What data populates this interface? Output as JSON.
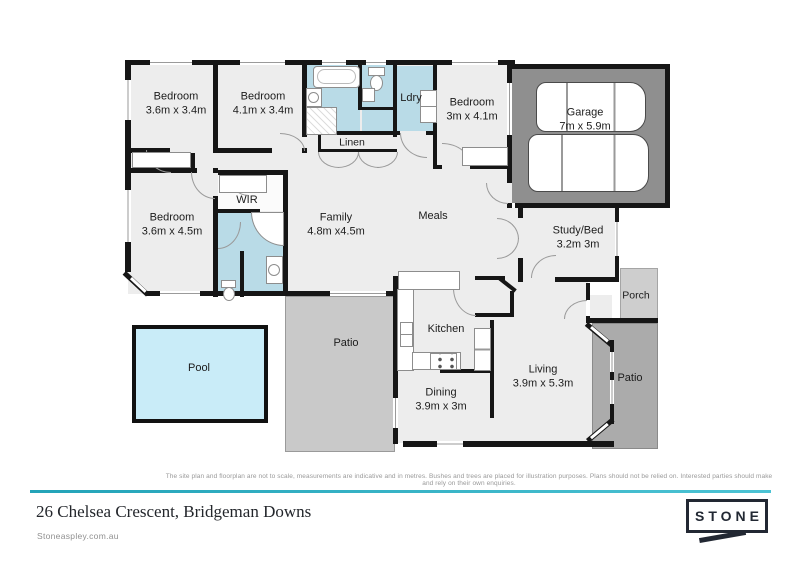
{
  "floorplan": {
    "rooms": [
      {
        "label": "Bedroom",
        "dims": "3.6m x 3.4m"
      },
      {
        "label": "Bedroom",
        "dims": "4.1m x 3.4m"
      },
      {
        "label": "Linen",
        "dims": ""
      },
      {
        "label": "Ldry",
        "dims": ""
      },
      {
        "label": "Bedroom",
        "dims": "3m x 4.1m"
      },
      {
        "label": "Garage",
        "dims": "7m x 5.9m"
      },
      {
        "label": "WIR",
        "dims": ""
      },
      {
        "label": "Bedroom",
        "dims": "3.6m x 4.5m"
      },
      {
        "label": "Family",
        "dims": "4.8m x4.5m"
      },
      {
        "label": "Meals",
        "dims": ""
      },
      {
        "label": "Study/Bed",
        "dims": "3.2m 3m"
      },
      {
        "label": "Porch",
        "dims": ""
      },
      {
        "label": "Kitchen",
        "dims": ""
      },
      {
        "label": "Dining",
        "dims": "3.9m x 3m"
      },
      {
        "label": "Living",
        "dims": "3.9m x 5.3m"
      },
      {
        "label": "Patio",
        "dims": ""
      },
      {
        "label": "Patio",
        "dims": ""
      },
      {
        "label": "Pool",
        "dims": ""
      }
    ]
  },
  "footer": {
    "disclaimer": "The site plan and floorplan are not to scale, measurements are indicative and in metres. Bushes and trees are placed for illustration purposes. Plans should not be relied on. Interested parties should make and rely on their own enquiries.",
    "address": "26 Chelsea Crescent, Bridgeman Downs",
    "website": "Stoneaspley.com.au",
    "logo_text": "STONE"
  },
  "colors": {
    "accent_teal": "#3bb6c6",
    "wet_area_blue": "#b9dbe7",
    "garage_gray": "#8f8f8f",
    "pool_blue": "#c9ecf8"
  }
}
